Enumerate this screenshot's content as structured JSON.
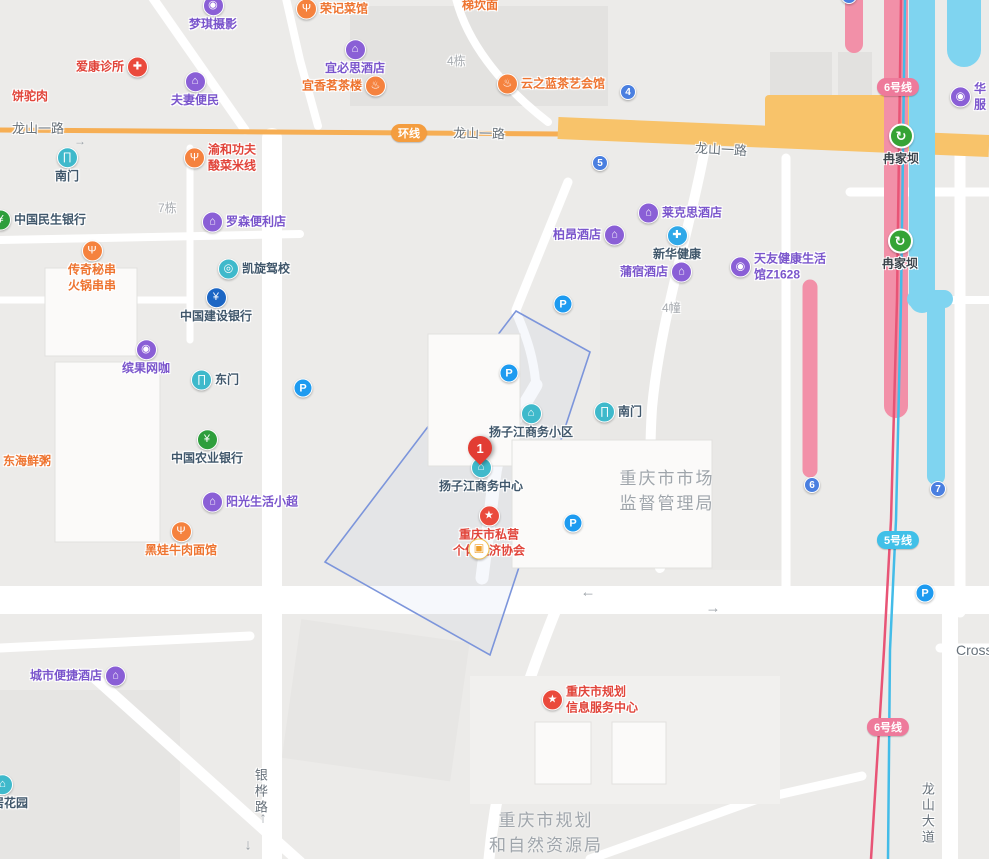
{
  "pois": {
    "mengqi": {
      "label": "梦琪摄影",
      "glyph": "◉"
    },
    "aikang": {
      "label": "爱康诊所",
      "glyph": "✚"
    },
    "fuqi": {
      "label": "夫妻便民",
      "glyph": "⌂"
    },
    "bingtuorou": {
      "label": "饼驼肉"
    },
    "rongji": {
      "label": "荣记菜馆",
      "glyph": "Ψ"
    },
    "tikanmian": {
      "label": "梯坎面"
    },
    "yibisi": {
      "label": "宜必思酒店",
      "glyph": "⌂"
    },
    "yixiang": {
      "label": "宜香茗茶楼",
      "glyph": "♨"
    },
    "yunzhilan": {
      "label": "云之蓝茶艺会馆",
      "glyph": "♨"
    },
    "huafu": {
      "line1": "华",
      "line2": "服",
      "glyph": "◉"
    },
    "nanmen_w": {
      "label": "南门",
      "glyph": "∏"
    },
    "yuhe": {
      "line1": "渝和功夫",
      "line2": "酸菜米线",
      "glyph": "Ψ"
    },
    "minsheng": {
      "label": "中国民生银行",
      "glyph": "¥"
    },
    "luosen": {
      "label": "罗森便利店",
      "glyph": "⌂"
    },
    "chuanqi": {
      "line1": "传奇秘串",
      "line2": "火锅串串",
      "glyph": "Ψ"
    },
    "kaixuan": {
      "label": "凯旋驾校",
      "glyph": "◎"
    },
    "ccb": {
      "label": "中国建设银行",
      "glyph": "¥"
    },
    "laikesi": {
      "label": "莱克思酒店",
      "glyph": "⌂"
    },
    "boang": {
      "label": "柏昂酒店",
      "glyph": "⌂"
    },
    "xinhua": {
      "label": "新华健康",
      "glyph": "✚"
    },
    "pusu": {
      "label": "蒲宿酒店",
      "glyph": "⌂"
    },
    "tianyou": {
      "line1": "天友健康生活",
      "line2": "馆Z1628",
      "glyph": "◉"
    },
    "binguo": {
      "label": "缤果网咖",
      "glyph": "◉"
    },
    "dongmen": {
      "label": "东门",
      "glyph": "∏"
    },
    "abc": {
      "label": "中国农业银行",
      "glyph": "¥"
    },
    "donghai": {
      "label": "东海鲜粥"
    },
    "yangguang": {
      "label": "阳光生活小超",
      "glyph": "⌂"
    },
    "heiwa": {
      "label": "黑娃牛肉面馆",
      "glyph": "Ψ"
    },
    "yzj_xiaoqu": {
      "label": "扬子江商务小区",
      "glyph": "⌂"
    },
    "nanmen_c": {
      "label": "南门",
      "glyph": "∏"
    },
    "yzj_center": {
      "label": "扬子江商务中心",
      "glyph": "⌂"
    },
    "siying": {
      "line1": "重庆市私营",
      "line2": "个体经济协会",
      "glyph": "★",
      "overlay_glyph": "▣"
    },
    "guihua": {
      "line1": "重庆市规划",
      "line2": "信息服务中心",
      "glyph": "★"
    },
    "chengshi": {
      "label": "城市便捷酒店",
      "glyph": "⌂"
    },
    "juhuayuan": {
      "label": "居花园",
      "glyph": "⌂"
    }
  },
  "station": {
    "label": "冉家坝",
    "glyph": "↻"
  },
  "marker": {
    "number": "1"
  },
  "parking": {
    "glyph": "P"
  },
  "badges": {
    "huanxian": "环线",
    "line5": "5号线",
    "line6": "6号线",
    "n4": "4",
    "n5": "5",
    "n6": "6",
    "n7": "7"
  },
  "roads": {
    "longshan_yilu": "龙山一路",
    "yinhua_lu": "银桦路",
    "longshan_dadao": "龙山大道",
    "cross": "Cross"
  },
  "areas": {
    "jianguan_l1": "重庆市市场",
    "jianguan_l2": "监督管理局",
    "ziran_l1": "重庆市规划",
    "ziran_l2": "和自然资源局"
  },
  "buildings": {
    "b4dong": "4栋",
    "b7dong": "7栋",
    "b4zhuang": "4幢"
  },
  "arrows": {
    "left": "←",
    "right": "→",
    "up": "↑",
    "down": "↓"
  },
  "colors": {
    "road_orange": "#F8C36A",
    "metro_pink": "#F290A8",
    "metro_cyan": "#7FD4F0",
    "line_pink": "#E85476",
    "line_cyan": "#43BCE8",
    "selection_blue": "#7C95DB"
  }
}
